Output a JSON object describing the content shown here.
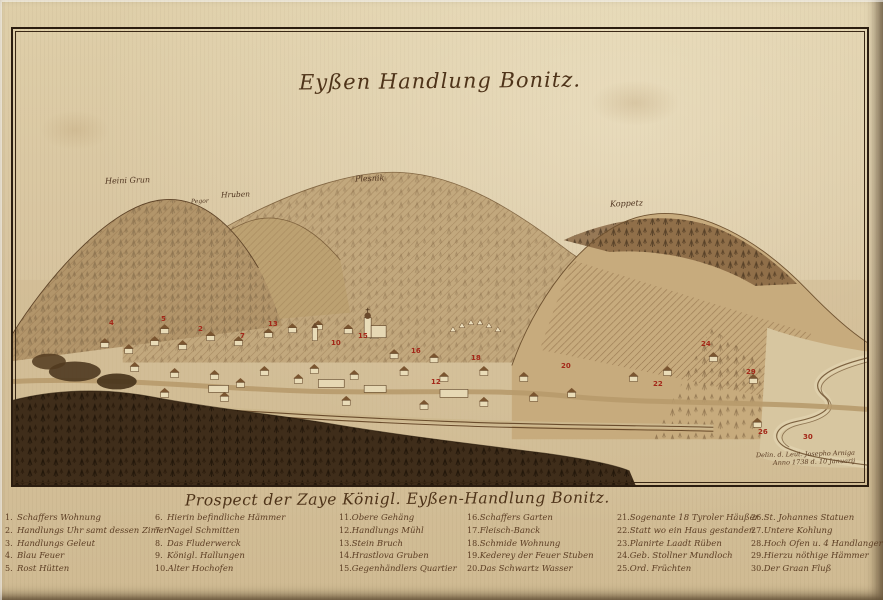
{
  "title": "Eyßen Handlung Bonitz.",
  "palette": {
    "paper": "#d8c5a1",
    "ink": "#4b3420",
    "marker_red": "#a32718",
    "hill_wash": "#c2a87d",
    "forest": "#3f2d1a"
  },
  "hill_labels": [
    {
      "text": "Heini Grun",
      "x": 92,
      "y": 147,
      "fs": 8
    },
    {
      "text": "Pegor",
      "x": 178,
      "y": 169,
      "fs": 6
    },
    {
      "text": "Hruben",
      "x": 208,
      "y": 161,
      "fs": 7.5
    },
    {
      "text": "Plesnik",
      "x": 342,
      "y": 145,
      "fs": 8
    },
    {
      "text": "Koppetz",
      "x": 597,
      "y": 170,
      "fs": 8
    }
  ],
  "markers": [
    {
      "n": "4",
      "x": 96,
      "y": 290
    },
    {
      "n": "5",
      "x": 148,
      "y": 286
    },
    {
      "n": "2",
      "x": 185,
      "y": 296
    },
    {
      "n": "7",
      "x": 227,
      "y": 303
    },
    {
      "n": "13",
      "x": 255,
      "y": 291
    },
    {
      "n": "10",
      "x": 318,
      "y": 310
    },
    {
      "n": "15",
      "x": 345,
      "y": 303
    },
    {
      "n": "16",
      "x": 398,
      "y": 318
    },
    {
      "n": "12",
      "x": 418,
      "y": 349
    },
    {
      "n": "18",
      "x": 458,
      "y": 325
    },
    {
      "n": "20",
      "x": 548,
      "y": 333
    },
    {
      "n": "22",
      "x": 640,
      "y": 351
    },
    {
      "n": "24",
      "x": 688,
      "y": 311
    },
    {
      "n": "29",
      "x": 733,
      "y": 339
    },
    {
      "n": "26",
      "x": 745,
      "y": 399
    },
    {
      "n": "30",
      "x": 790,
      "y": 404
    }
  ],
  "signature": {
    "line1": "Delin. d. Leut. Josepho Arniga",
    "line2": "Anno 1738 d. 10 Januarij"
  },
  "legend": {
    "header": "Prospect der Zaye Königl. Eyßen-Handlung Bonitz.",
    "columns": [
      [
        {
          "num": "1.",
          "text": "Schaffers Wohnung"
        },
        {
          "num": "2.",
          "text": "Handlungs Uhr samt dessen Zimer"
        },
        {
          "num": "3.",
          "text": "Handlungs Geleut"
        },
        {
          "num": "4.",
          "text": "Blau Feuer"
        },
        {
          "num": "5.",
          "text": "Rost Hütten"
        }
      ],
      [
        {
          "num": "6.",
          "text": "Hierin befindliche Hämmer"
        },
        {
          "num": "7.",
          "text": "Nagel Schmitten"
        },
        {
          "num": "8.",
          "text": "Das Fluderwerck"
        },
        {
          "num": "9.",
          "text": "Königl. Hallungen"
        },
        {
          "num": "10.",
          "text": "Alter Hochofen"
        }
      ],
      [
        {
          "num": "11.",
          "text": "Obere Gehäng"
        },
        {
          "num": "12.",
          "text": "Handlungs Mühl"
        },
        {
          "num": "13.",
          "text": "Stein Bruch"
        },
        {
          "num": "14.",
          "text": "Hrastlova Gruben"
        },
        {
          "num": "15.",
          "text": "Gegenhändlers Quartier"
        }
      ],
      [
        {
          "num": "16.",
          "text": "Schaffers Garten"
        },
        {
          "num": "17.",
          "text": "Fleisch-Banck"
        },
        {
          "num": "18.",
          "text": "Schmide Wohnung"
        },
        {
          "num": "19.",
          "text": "Kederey der Feuer Stuben"
        },
        {
          "num": "20.",
          "text": "Das Schwartz Wasser"
        }
      ],
      [
        {
          "num": "21.",
          "text": "Sogenante 18 Tyroler Häußer"
        },
        {
          "num": "22.",
          "text": "Statt wo ein Haus gestanden"
        },
        {
          "num": "23.",
          "text": "Planirte Laadt Rüben"
        },
        {
          "num": "24.",
          "text": "Geb. Stollner Mundloch"
        },
        {
          "num": "25.",
          "text": "Ord. Früchten"
        }
      ],
      [
        {
          "num": "26.",
          "text": "St. Johannes Statuen"
        },
        {
          "num": "27.",
          "text": "Untere Kohlung"
        },
        {
          "num": "28.",
          "text": "Hoch Ofen u. 4 Handlangern"
        },
        {
          "num": "29.",
          "text": "Hierzu nöthige Hämmer"
        },
        {
          "num": "30.",
          "text": "Der Graan Fluß"
        }
      ]
    ]
  }
}
